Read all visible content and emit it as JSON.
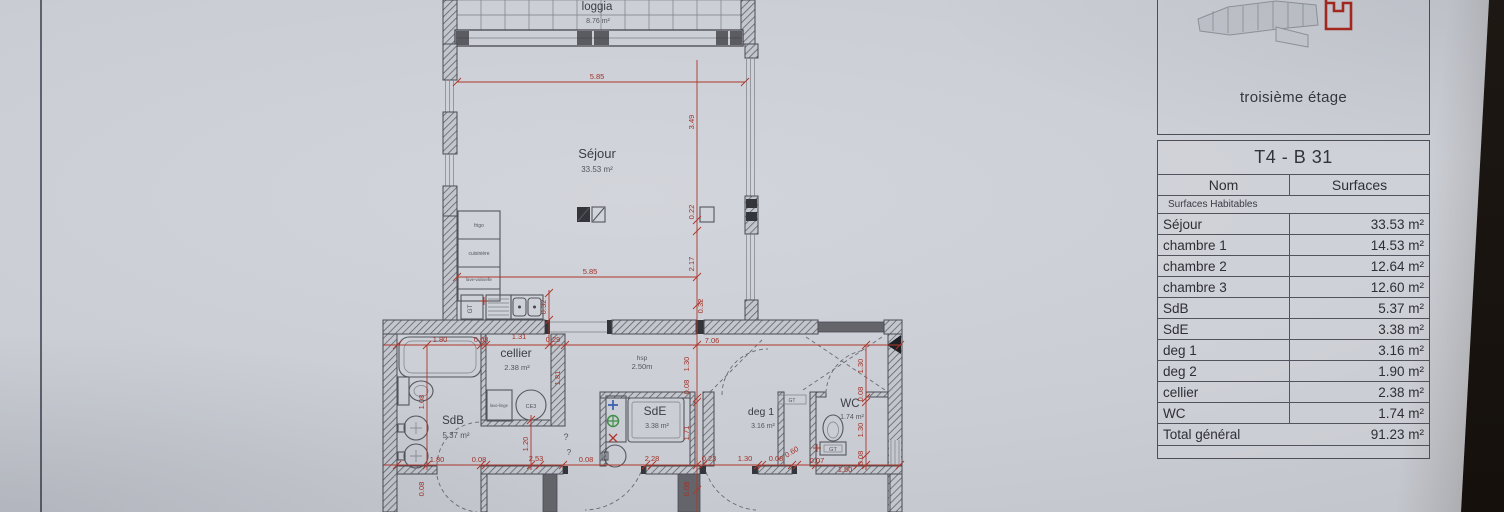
{
  "colors": {
    "paper": "#cbced5",
    "ink": "#45464d",
    "dimension_red": "#a93226",
    "highlight_red": "#a8281e",
    "plumb_blue": "#3b5fb2",
    "plumb_green": "#3f8f46",
    "background_dark": "#15100c"
  },
  "key_panel": {
    "floor_label": "troisième étage"
  },
  "table": {
    "title": "T4 - B 31",
    "columns": {
      "name": "Nom",
      "surface": "Surfaces"
    },
    "section": "Surfaces Habitables",
    "rows": [
      {
        "name": "Séjour",
        "value": "33.53 m²"
      },
      {
        "name": "chambre 1",
        "value": "14.53 m²"
      },
      {
        "name": "chambre 2",
        "value": "12.64 m²"
      },
      {
        "name": "chambre 3",
        "value": "12.60 m²"
      },
      {
        "name": "SdB",
        "value": "5.37 m²"
      },
      {
        "name": "SdE",
        "value": "3.38 m²"
      },
      {
        "name": "deg 1",
        "value": "3.16 m²"
      },
      {
        "name": "deg 2",
        "value": "1.90 m²"
      },
      {
        "name": "cellier",
        "value": "2.38 m²"
      },
      {
        "name": "WC",
        "value": "1.74 m²"
      }
    ],
    "total": {
      "name": "Total général",
      "value": "91.23 m²"
    }
  },
  "plan": {
    "rooms": {
      "loggia": {
        "name": "loggia",
        "area": "8.76 m²"
      },
      "sejour": {
        "name": "Séjour",
        "area": "33.53 m²"
      },
      "cellier": {
        "name": "cellier",
        "area": "2.38 m²"
      },
      "sdb": {
        "name": "SdB",
        "area": "5.37 m²"
      },
      "sde": {
        "name": "SdE",
        "area": "3.38 m²"
      },
      "deg1": {
        "name": "deg 1",
        "area": "3.16 m²"
      },
      "wc": {
        "name": "WC",
        "area": "1.74 m²"
      }
    },
    "labels": {
      "hsp": "hsp",
      "hsp_value": "2.50m",
      "gt": "GT",
      "frigo": "frigo",
      "cuisiniere": "cuisinière",
      "lave_vaisselle": "lave-vaisselle",
      "lave_linge": "lave-linge",
      "ce": "CE3",
      "question": "?"
    },
    "dims": [
      "5.85",
      "3.49",
      "0.22",
      "2.17",
      "5.85",
      "0.32",
      "0.32",
      "1.80",
      "0.08",
      "1.31",
      "0.29",
      "7.06",
      "1.81",
      "1.30",
      "0.08",
      "1.71",
      "0.08",
      "1.08",
      "0.08",
      "1.20",
      "1.30",
      "0.08",
      "1.30",
      "0.08",
      "1.80",
      "0.08",
      "2.53",
      "0.08",
      "2.28",
      "0.23",
      "1.30",
      "0.08",
      "0.60",
      "0.07",
      "1.50"
    ]
  }
}
